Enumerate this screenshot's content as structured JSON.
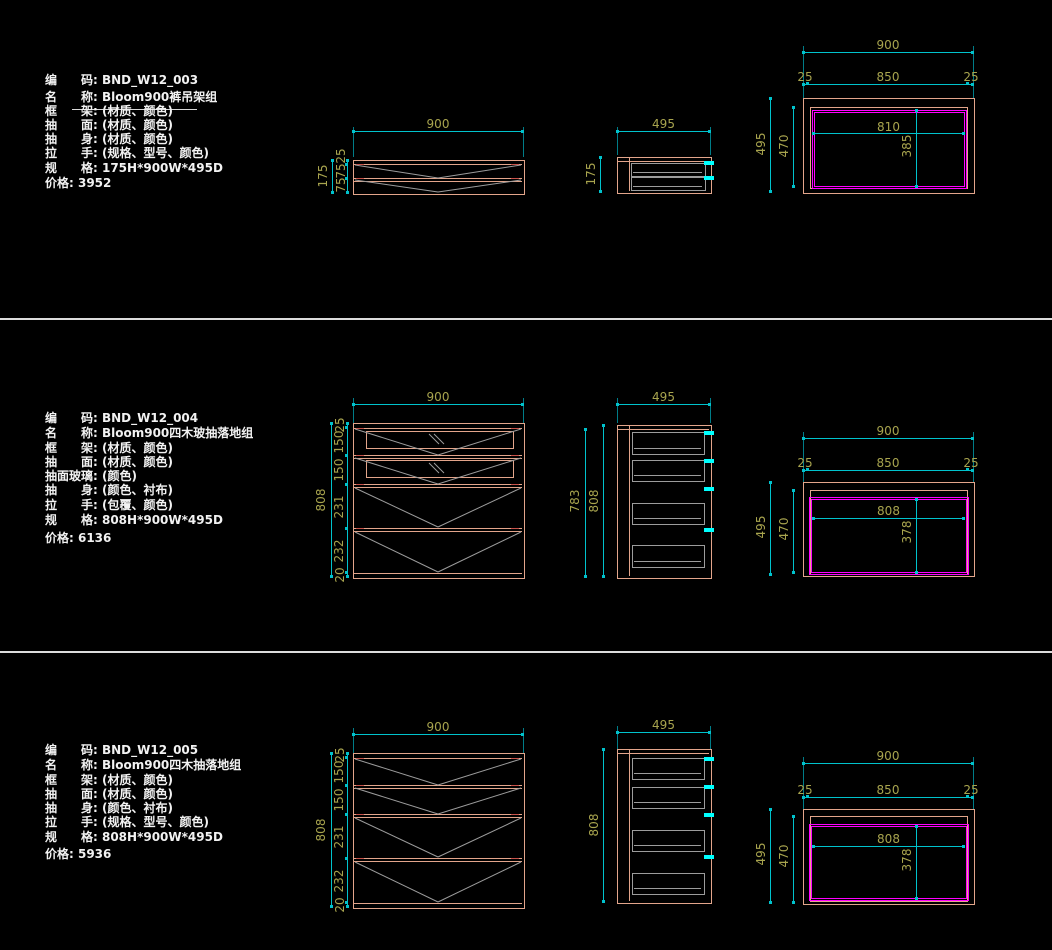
{
  "colors": {
    "background": "#000000",
    "outline": "#e3a58b",
    "opening": "#ff00ff",
    "dim_line": "#00c2cc",
    "dim_text": "#a8a44e",
    "drawer_line": "#9c9c9c",
    "handle": "#00ffff",
    "spec_text": "#f2f2f2"
  },
  "rows": [
    {
      "info": [
        "编　　码: BND_W12_003",
        "名　　称: Bloom900裤吊架组",
        "框　　架: (材质、颜色)",
        "抽　　面: (材质、颜色)",
        "抽　　身: (材质、颜色)",
        "拉　　手: (规格、型号、颜色)",
        "规　　格: 175H*900W*495D",
        "价格: 3952"
      ],
      "front": {
        "w": "900",
        "total": "175",
        "segs": [
          "25",
          "75",
          "75"
        ]
      },
      "side": {
        "w": "495",
        "h": "175"
      },
      "plan": {
        "w": "900",
        "edge_l": "25",
        "frame_w": "850",
        "edge_r": "25",
        "depth": "495",
        "depth_inner": "470",
        "open_w": "810",
        "open_d": "385"
      }
    },
    {
      "info": [
        "编　　码: BND_W12_004",
        "名　　称: Bloom900四木玻抽落地组",
        "框　　架: (材质、颜色)",
        "抽　　面: (材质、颜色)",
        "抽面玻璃: (颜色)",
        "抽　　身: (颜色、衬布)",
        "拉　　手: (包覆、颜色)",
        "规　　格: 808H*900W*495D",
        "价格: 6136"
      ],
      "front": {
        "w": "900",
        "total": "808",
        "segs": [
          "25",
          "150",
          "150",
          "231",
          "232",
          "20"
        ]
      },
      "side": {
        "w": "495",
        "h": "808",
        "h2": "783"
      },
      "plan": {
        "w": "900",
        "edge_l": "25",
        "frame_w": "850",
        "edge_r": "25",
        "depth": "495",
        "depth_inner": "470",
        "open_w": "808",
        "open_d": "378"
      }
    },
    {
      "info": [
        "编　　码: BND_W12_005",
        "名　　称: Bloom900四木抽落地组",
        "框　　架: (材质、颜色)",
        "抽　　面: (材质、颜色)",
        "抽　　身: (颜色、衬布)",
        "拉　　手: (规格、型号、颜色)",
        "规　　格: 808H*900W*495D",
        "价格: 5936"
      ],
      "front": {
        "w": "900",
        "total": "808",
        "segs": [
          "25",
          "150",
          "150",
          "231",
          "232",
          "20"
        ]
      },
      "side": {
        "w": "495",
        "h": "808"
      },
      "plan": {
        "w": "900",
        "edge_l": "25",
        "frame_w": "850",
        "edge_r": "25",
        "depth": "495",
        "depth_inner": "470",
        "open_w": "808",
        "open_d": "378"
      }
    }
  ]
}
